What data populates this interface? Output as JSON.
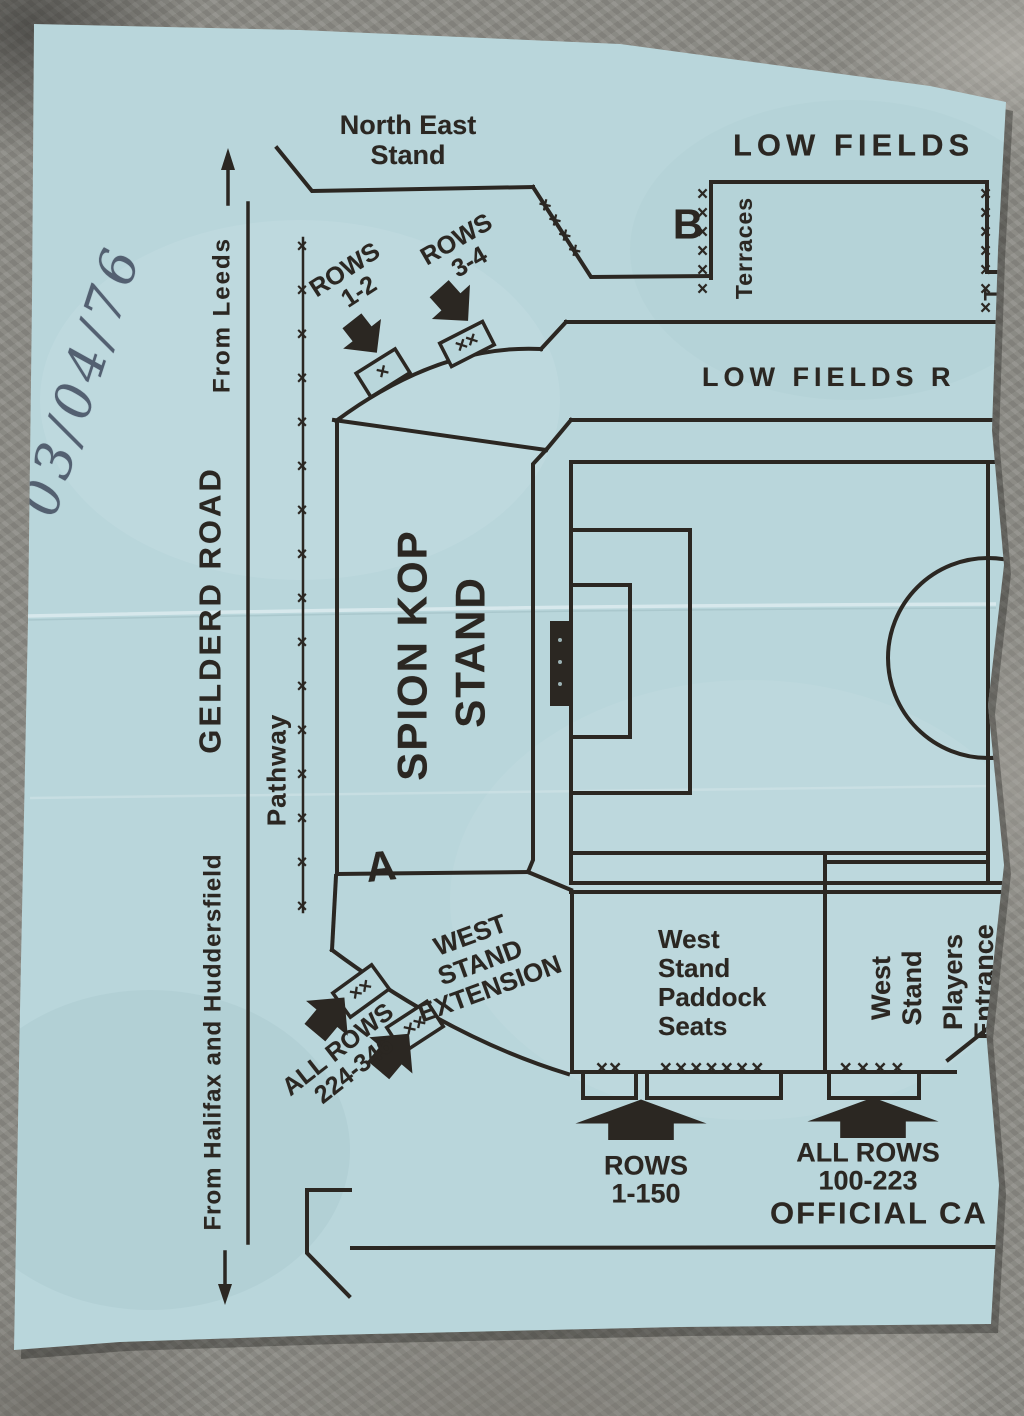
{
  "photo": {
    "handwritten_date": "03/04/76"
  },
  "map": {
    "labels": {
      "north_east_stand": "North East\nStand",
      "low_fields_top": "LOW FIELDS",
      "low_fields_road": "LOW FIELDS R",
      "terraces": "Terraces",
      "terraces_cut": "T",
      "section_b": "B",
      "section_a": "A",
      "spion_kop_line1": "SPION KOP",
      "spion_kop_line2": "STAND",
      "west_stand_extension": "WEST\nSTAND\nEXTENSION",
      "west_stand_paddock": "West\nStand\nPaddock\nSeats",
      "west_stand": "West\nStand",
      "players_entrance": "Players\nEntrance",
      "gelderd_road": "GELDERD ROAD",
      "from_leeds": "From Leeds",
      "from_halifax": "From Halifax and Huddersfield",
      "pathway": "Pathway",
      "official_car_park": "OFFICIAL CA"
    },
    "rows": {
      "kop_rows_1_2": "ROWS\n1-2",
      "kop_rows_3_4": "ROWS\n3-4",
      "west_ext_rows": "ALL ROWS\n224-346",
      "paddock_rows": "ROWS\n1-150",
      "west_stand_rows": "ALL ROWS\n100-223"
    },
    "fences": {
      "pathway_fence": "××××××××××××××××",
      "ne_stand_fence": "××××",
      "b_box_left_fence": "××××××",
      "b_box_right_fence": "×××××××",
      "kop_gate1": "×",
      "kop_gate2": "××",
      "west_ext_gate1": "××",
      "west_ext_gate2": "××",
      "paddock_turnstile_small": "××",
      "paddock_turnstile_large": "×××××××",
      "west_stand_turnstile": "××××"
    }
  },
  "colors": {
    "paper": "#b9d6db",
    "ink": "#2b2722",
    "pen": "#4a5668",
    "stone": "#8d8c86"
  }
}
